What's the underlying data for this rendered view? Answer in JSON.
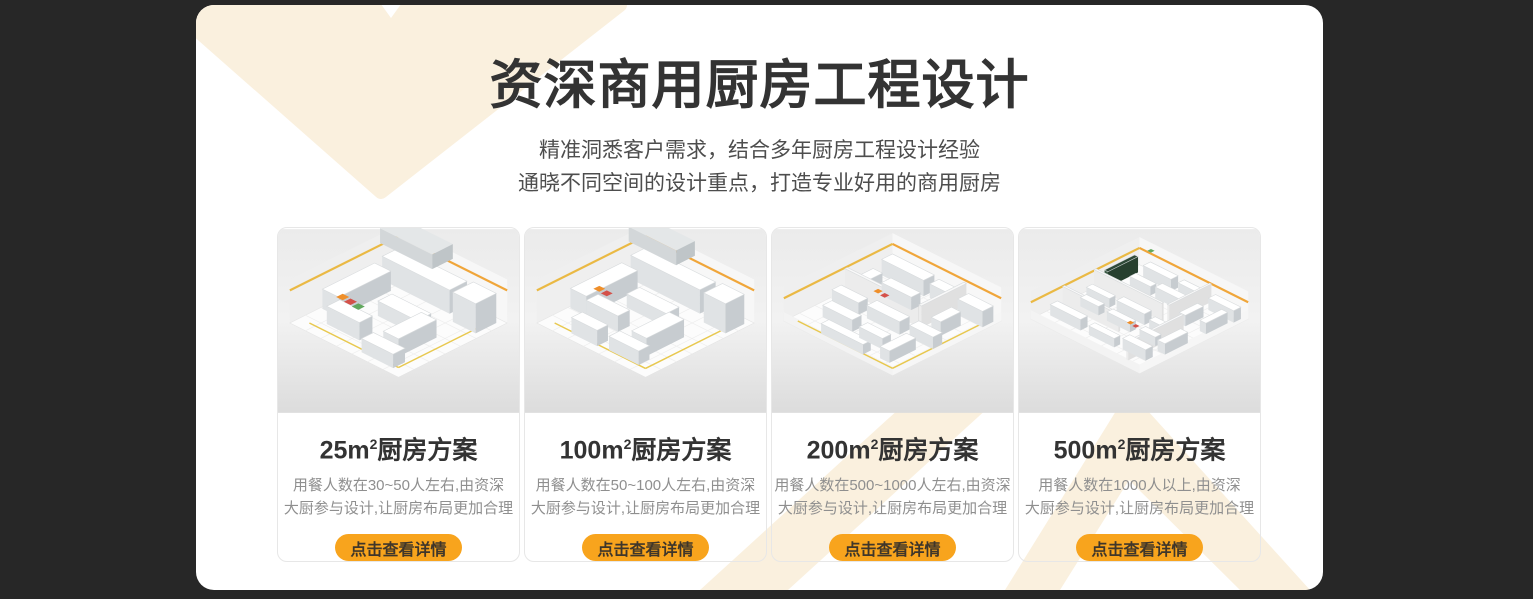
{
  "header": {
    "title": "资深商用厨房工程设计",
    "subtitle_line1": "精准洞悉客户需求，结合多年厨房工程设计经验",
    "subtitle_line2": "通晓不同空间的设计重点，打造专业好用的商用厨房"
  },
  "cards": [
    {
      "title_prefix": "25m",
      "title_sup": "2",
      "title_suffix": "厨房方案",
      "desc_line1": "用餐人数在30~50人左右,由资深",
      "desc_line2": "大厨参与设计,让厨房布局更加合理",
      "button_label": "点击查看详情",
      "image": "isometric-kitchen-render-25m2"
    },
    {
      "title_prefix": "100m",
      "title_sup": "2",
      "title_suffix": "厨房方案",
      "desc_line1": "用餐人数在50~100人左右,由资深",
      "desc_line2": "大厨参与设计,让厨房布局更加合理",
      "button_label": "点击查看详情",
      "image": "isometric-kitchen-render-100m2"
    },
    {
      "title_prefix": "200m",
      "title_sup": "2",
      "title_suffix": "厨房方案",
      "desc_line1": "用餐人数在500~1000人左右,由资深",
      "desc_line2": "大厨参与设计,让厨房布局更加合理",
      "button_label": "点击查看详情",
      "image": "isometric-kitchen-render-200m2"
    },
    {
      "title_prefix": "500m",
      "title_sup": "2",
      "title_suffix": "厨房方案",
      "desc_line1": "用餐人数在1000人以上,由资深",
      "desc_line2": "大厨参与设计,让厨房布局更加合理",
      "button_label": "点击查看详情",
      "image": "isometric-kitchen-render-500m2"
    }
  ],
  "colors": {
    "page_background": "#272727",
    "panel_background": "#ffffff",
    "pattern_cream": "#FAF0DE",
    "accent_orange": "#F8A41D",
    "title_text": "#333333",
    "subtitle_text": "#4D4D4D",
    "card_desc_text": "#8F8F8F",
    "button_text": "#3F362A"
  }
}
